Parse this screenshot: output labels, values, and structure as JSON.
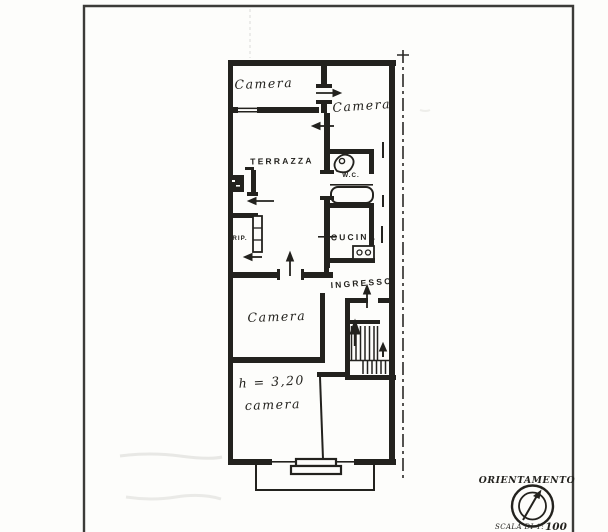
{
  "document": {
    "kind_label": "floor-plan-scan",
    "ink_color": "#23221e",
    "paper_color": "#fdfdfb"
  },
  "plan": {
    "labels": {
      "camera_top_left": "Camera",
      "camera_top_right": "Camera",
      "terrazza": "TERRAZZA",
      "wc": "W.C.",
      "cucina": "CUCINA",
      "rip": "RIP.",
      "ingresso": "INGRESSO",
      "camera_middle": "Camera",
      "ceiling_height": "h = 3,20",
      "camera_bottom": "camera"
    },
    "orientation": {
      "title": "ORIENTAMENTO"
    },
    "scale": {
      "prefix": "SCALA DI 1:",
      "value": "100"
    }
  }
}
